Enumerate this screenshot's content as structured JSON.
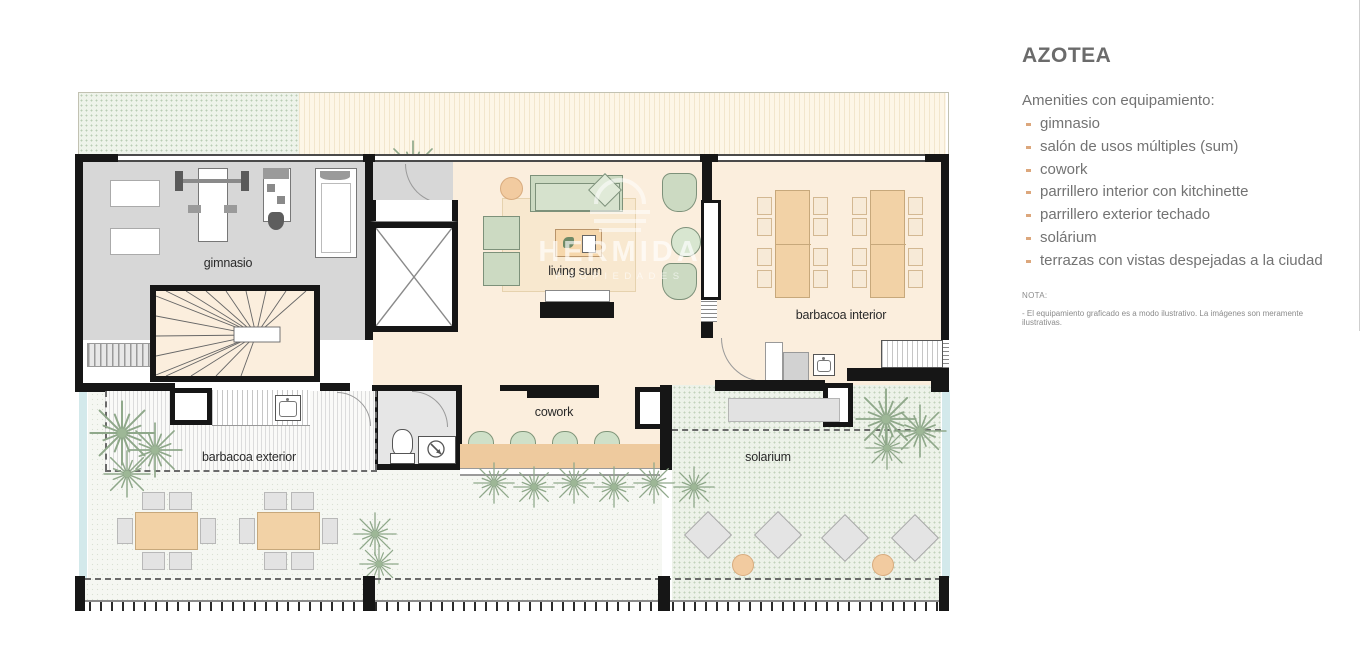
{
  "panel": {
    "title": "AZOTEA",
    "subtitle": "Amenities con equipamiento:",
    "amenities": [
      "gimnasio",
      "salón de usos múltiples (sum)",
      "cowork",
      "parrillero interior con kitchinette",
      "parrillero exterior techado",
      "solárium",
      "terrazas con vistas despejadas a la ciudad"
    ],
    "note_label": "NOTA:",
    "note_text": "- El equipamiento graficado es a modo ilustrativo. La imágenes son meramente ilustrativas."
  },
  "plan": {
    "labels": {
      "gimnasio": "gimnasio",
      "living_sum": "living sum",
      "barbacoa_interior": "barbacoa interior",
      "cowork": "cowork",
      "barbacoa_exterior": "barbacoa exterior",
      "solarium": "solarium"
    },
    "watermark": {
      "brand": "HERMIDA",
      "tagline": "PROPIEDADES"
    }
  },
  "colors": {
    "wall": "#161616",
    "interior_floor": "#fbeedd",
    "gym_floor": "#d7d7d7",
    "terrace_green": "#eef3ea",
    "table_tan": "#f2d2a6",
    "furniture_green": "#ccdac2",
    "glass": "#d3e9eb",
    "bullet_accent": "#dca77c"
  }
}
